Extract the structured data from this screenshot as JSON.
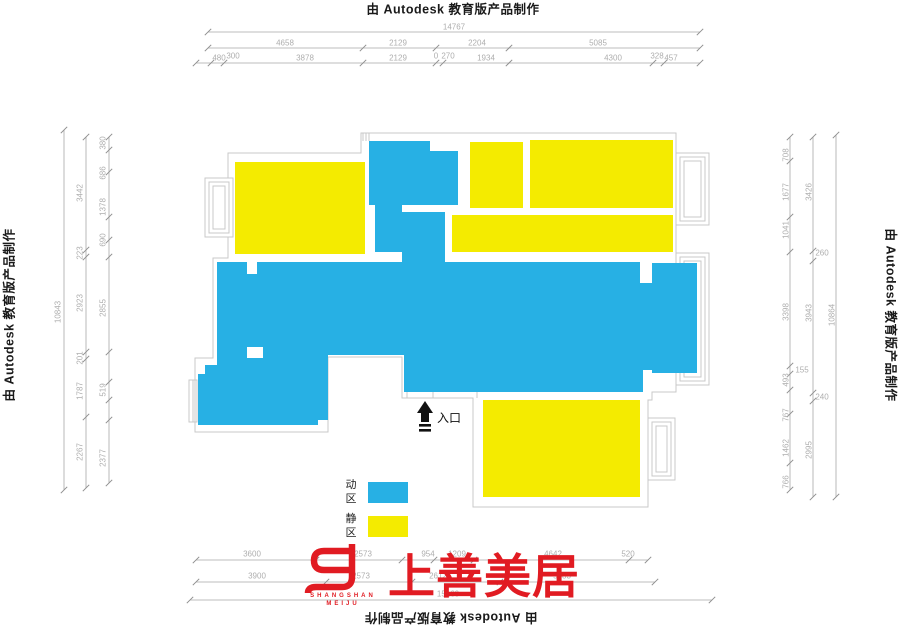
{
  "colors": {
    "active_zone": "#27b0e4",
    "quiet_zone": "#f4eb00",
    "logo_red": "#e11b22",
    "dim_line": "#a8a8a8",
    "wall_line": "#c9c9c9"
  },
  "border_text": {
    "top": "由 Autodesk 教育版产品制作",
    "left": "由 Autodesk 教育版产品制作",
    "right": "由 Autodesk 教育版产品制作",
    "bottom": "由 Autodesk 教育版产品制作"
  },
  "legend": {
    "active": {
      "label": "动区",
      "color": "#27b0e4"
    },
    "quiet": {
      "label": "静区",
      "color": "#f4eb00"
    }
  },
  "entrance": {
    "label": "入口"
  },
  "logo": {
    "name_cn": "上善美居",
    "latin_line1": "SHANGSHAN",
    "latin_line2": "MEIJU",
    "color": "#e11b22"
  },
  "dimensions": {
    "top": [
      {
        "v": "14767",
        "x": 454,
        "y": 27,
        "r": 0
      },
      {
        "v": "4658",
        "x": 285,
        "y": 43,
        "r": 0
      },
      {
        "v": "2129",
        "x": 398,
        "y": 43,
        "r": 0
      },
      {
        "v": "2204",
        "x": 477,
        "y": 43,
        "r": 0
      },
      {
        "v": "5085",
        "x": 598,
        "y": 43,
        "r": 0
      },
      {
        "v": "480",
        "x": 219,
        "y": 58,
        "r": 0
      },
      {
        "v": "300",
        "x": 233,
        "y": 56,
        "r": 0
      },
      {
        "v": "3878",
        "x": 305,
        "y": 58,
        "r": 0
      },
      {
        "v": "2129",
        "x": 398,
        "y": 58,
        "r": 0
      },
      {
        "v": "0",
        "x": 436,
        "y": 56,
        "r": 0
      },
      {
        "v": "270",
        "x": 448,
        "y": 56,
        "r": 0
      },
      {
        "v": "1934",
        "x": 486,
        "y": 58,
        "r": 0
      },
      {
        "v": "4300",
        "x": 613,
        "y": 58,
        "r": 0
      },
      {
        "v": "328",
        "x": 657,
        "y": 56,
        "r": 0
      },
      {
        "v": "457",
        "x": 671,
        "y": 58,
        "r": 0
      }
    ],
    "left": [
      {
        "v": "10843",
        "x": 58,
        "y": 312,
        "r": -90
      },
      {
        "v": "3442",
        "x": 80,
        "y": 193,
        "r": -90
      },
      {
        "v": "223",
        "x": 80,
        "y": 253,
        "r": -90
      },
      {
        "v": "2923",
        "x": 80,
        "y": 303,
        "r": -90
      },
      {
        "v": "201",
        "x": 80,
        "y": 358,
        "r": -90
      },
      {
        "v": "1787",
        "x": 80,
        "y": 391,
        "r": -90
      },
      {
        "v": "2267",
        "x": 80,
        "y": 452,
        "r": -90
      },
      {
        "v": "380",
        "x": 103,
        "y": 143,
        "r": -90
      },
      {
        "v": "686",
        "x": 103,
        "y": 173,
        "r": -90
      },
      {
        "v": "1378",
        "x": 103,
        "y": 207,
        "r": -90
      },
      {
        "v": "690",
        "x": 103,
        "y": 240,
        "r": -90
      },
      {
        "v": "2855",
        "x": 103,
        "y": 308,
        "r": -90
      },
      {
        "v": "519",
        "x": 103,
        "y": 390,
        "r": -90
      },
      {
        "v": "2377",
        "x": 103,
        "y": 458,
        "r": -90
      }
    ],
    "right": [
      {
        "v": "708",
        "x": 786,
        "y": 155,
        "r": -90
      },
      {
        "v": "1677",
        "x": 786,
        "y": 192,
        "r": -90
      },
      {
        "v": "1041",
        "x": 786,
        "y": 230,
        "r": -90
      },
      {
        "v": "3398",
        "x": 786,
        "y": 312,
        "r": -90
      },
      {
        "v": "493",
        "x": 786,
        "y": 380,
        "r": -90
      },
      {
        "v": "767",
        "x": 786,
        "y": 415,
        "r": -90
      },
      {
        "v": "1462",
        "x": 786,
        "y": 448,
        "r": -90
      },
      {
        "v": "766",
        "x": 786,
        "y": 482,
        "r": -90
      },
      {
        "v": "155",
        "x": 802,
        "y": 370,
        "r": 0
      },
      {
        "v": "260",
        "x": 822,
        "y": 253,
        "r": 0
      },
      {
        "v": "240",
        "x": 822,
        "y": 397,
        "r": 0
      },
      {
        "v": "3426",
        "x": 809,
        "y": 192,
        "r": -90
      },
      {
        "v": "3943",
        "x": 809,
        "y": 313,
        "r": -90
      },
      {
        "v": "2995",
        "x": 809,
        "y": 450,
        "r": -90
      },
      {
        "v": "10864",
        "x": 832,
        "y": 315,
        "r": -90
      }
    ],
    "bottom": [
      {
        "v": "3600",
        "x": 252,
        "y": 554,
        "r": 0
      },
      {
        "v": "2573",
        "x": 363,
        "y": 554,
        "r": 0
      },
      {
        "v": "954",
        "x": 428,
        "y": 554,
        "r": 0
      },
      {
        "v": "1209",
        "x": 457,
        "y": 554,
        "r": 0
      },
      {
        "v": "4642",
        "x": 553,
        "y": 554,
        "r": 0
      },
      {
        "v": "520",
        "x": 628,
        "y": 554,
        "r": 0
      },
      {
        "v": "3900",
        "x": 257,
        "y": 576,
        "r": 0
      },
      {
        "v": "2573",
        "x": 361,
        "y": 576,
        "r": 0
      },
      {
        "v": "2612",
        "x": 438,
        "y": 576,
        "r": 0
      },
      {
        "v": "5583",
        "x": 562,
        "y": 576,
        "r": 0
      },
      {
        "v": "15160",
        "x": 448,
        "y": 594,
        "r": 0
      }
    ]
  }
}
